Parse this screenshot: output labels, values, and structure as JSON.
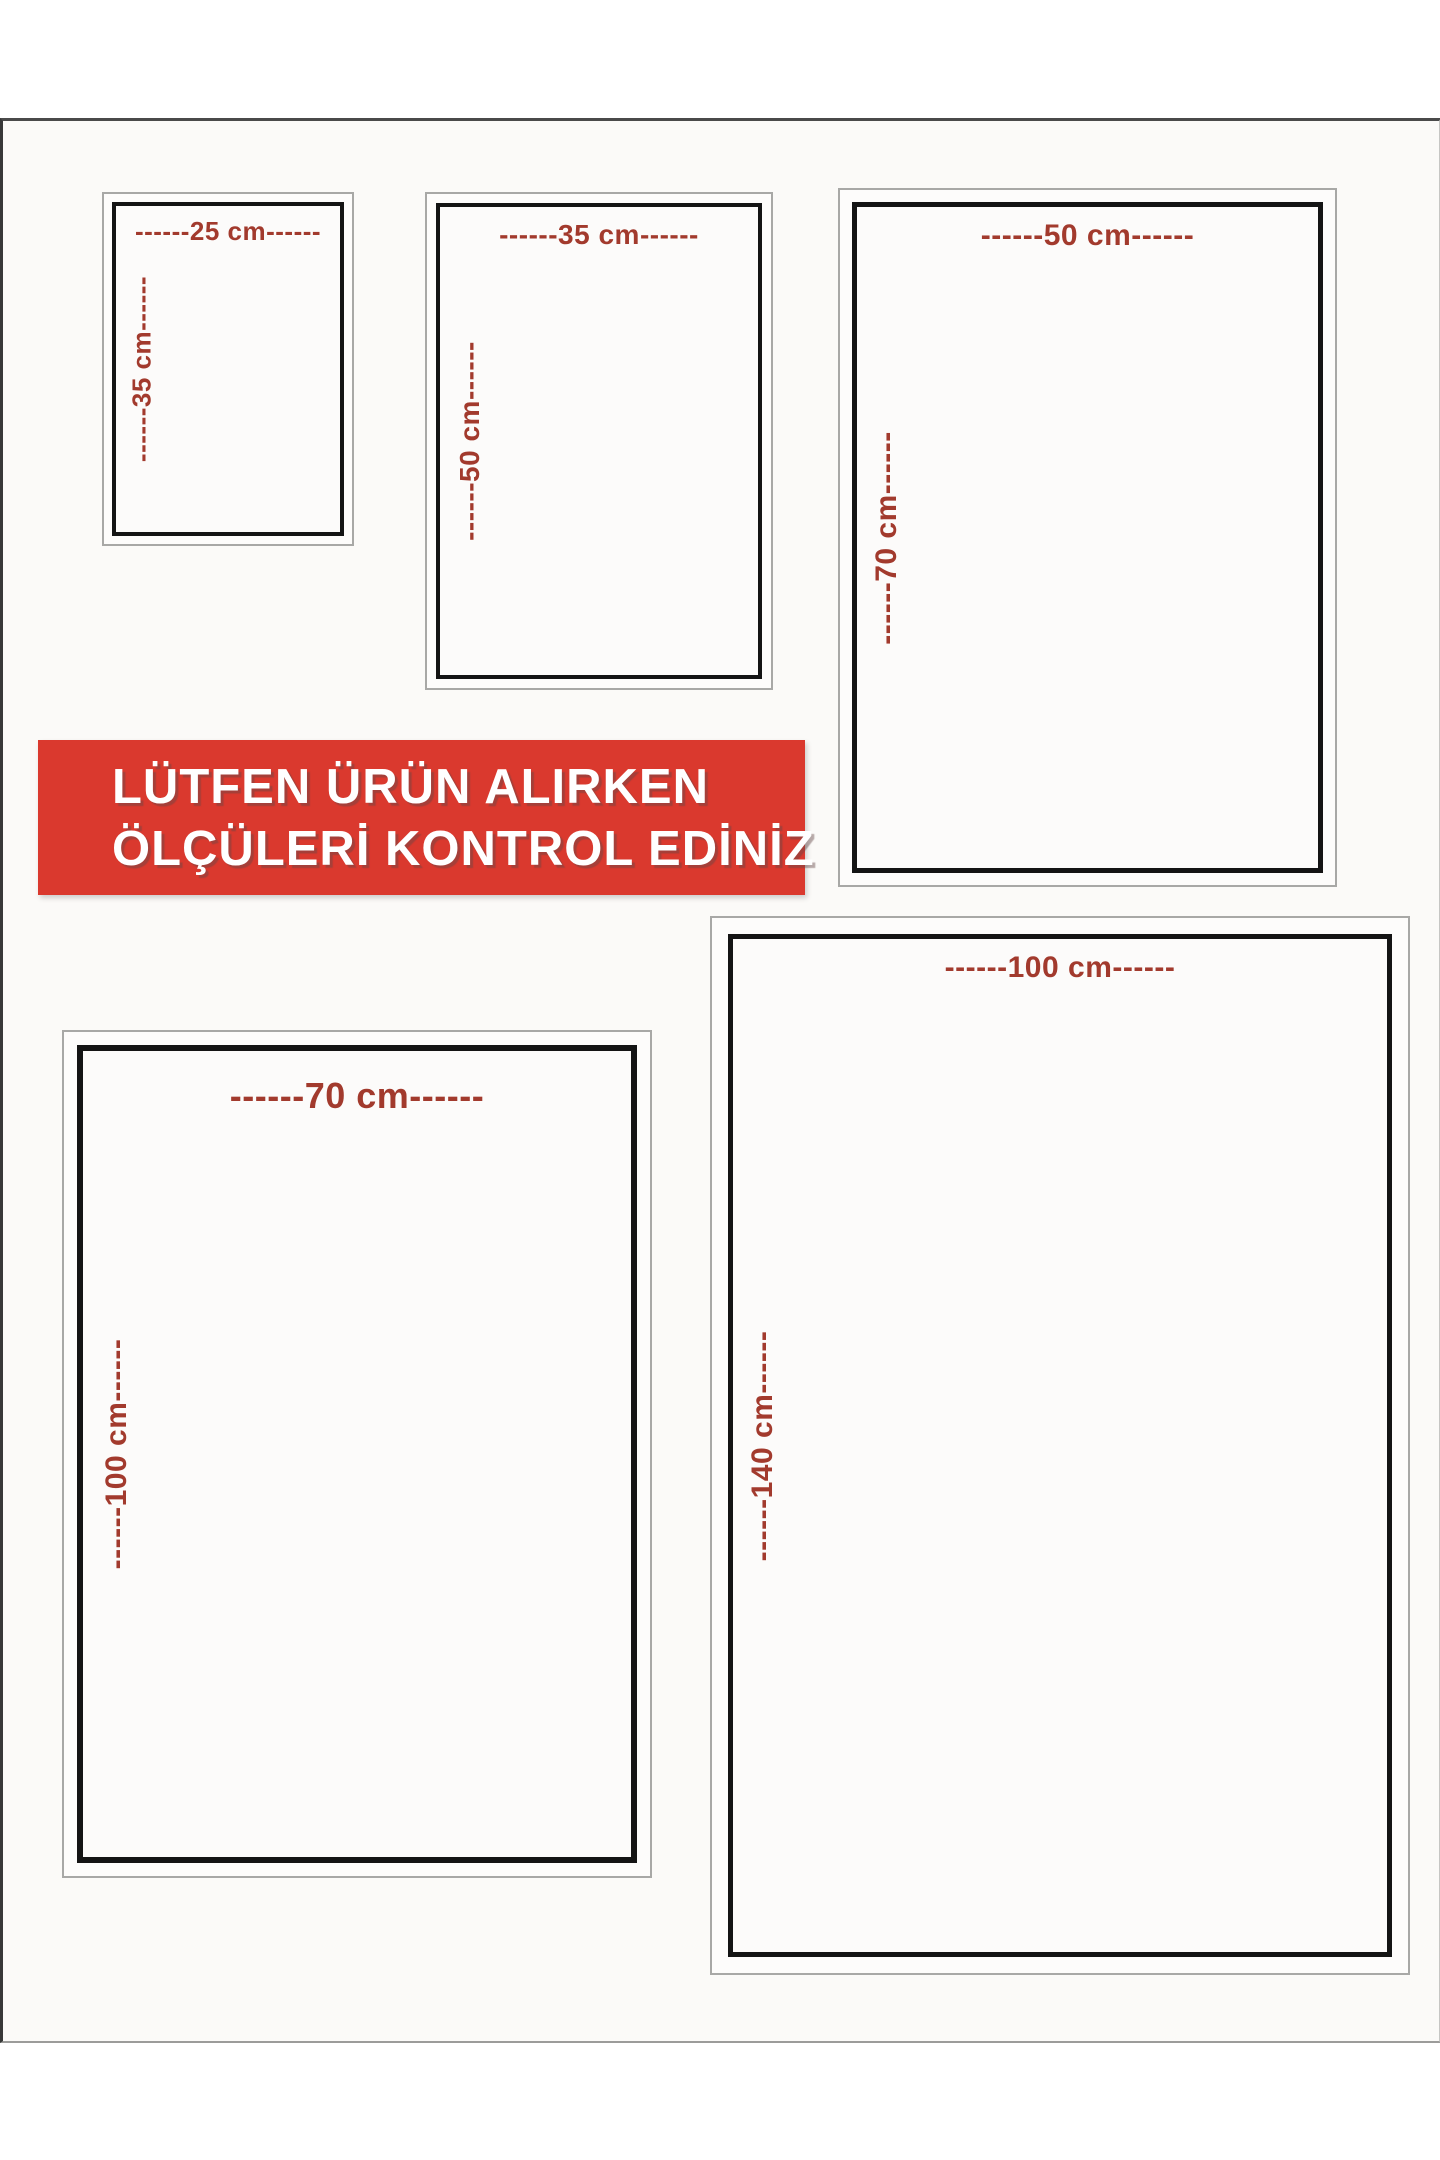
{
  "banner": {
    "line1": "LÜTFEN ÜRÜN ALIRKEN",
    "line2": "ÖLÇÜLERİ KONTROL EDİNİZ",
    "bg_color": "#da392e",
    "text_color": "#ffffff"
  },
  "colors": {
    "dimension_label_red": "#a23a2d",
    "inner_frame_black": "#141414",
    "outer_frame_gray": "#a8a8a6",
    "page_background": "#fbfaf8"
  },
  "sizes": [
    {
      "id": "25x35",
      "width_cm": 25,
      "height_cm": 35,
      "width_label": "------25 cm------",
      "height_label": "------35 cm------"
    },
    {
      "id": "35x50",
      "width_cm": 35,
      "height_cm": 50,
      "width_label": "------35 cm------",
      "height_label": "------50 cm------"
    },
    {
      "id": "50x70",
      "width_cm": 50,
      "height_cm": 70,
      "width_label": "------50 cm------",
      "height_label": "------70 cm------"
    },
    {
      "id": "70x100",
      "width_cm": 70,
      "height_cm": 100,
      "width_label": "------70 cm------",
      "height_label": "------100 cm------"
    },
    {
      "id": "100x140",
      "width_cm": 100,
      "height_cm": 140,
      "width_label": "------100 cm------",
      "height_label": "------140 cm------"
    }
  ]
}
